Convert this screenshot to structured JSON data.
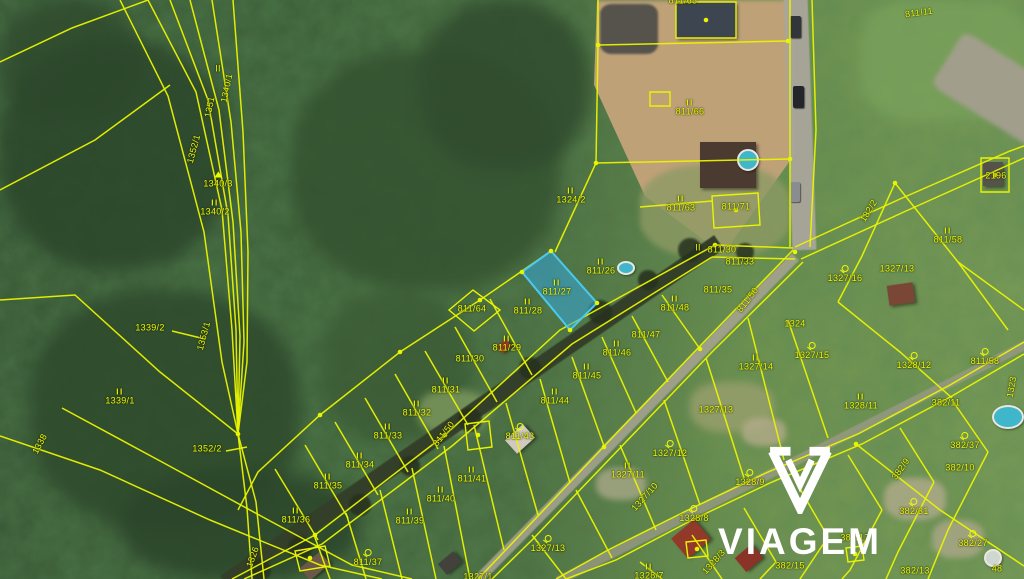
{
  "map": {
    "watermark": {
      "brand": "VIAGEM"
    },
    "highlight_parcel": {
      "number": "811/27",
      "fill": "#35a7dd",
      "stroke": "#49c8f0"
    },
    "line_color": "#e9f400",
    "label_color": "#f0fa00",
    "labels": [
      {
        "t": "1340/1",
        "x": 227,
        "y": 88,
        "r": -78
      },
      {
        "t": "1351",
        "x": 210,
        "y": 107,
        "r": -78
      },
      {
        "t": "1352/1",
        "x": 194,
        "y": 149,
        "r": -75
      },
      {
        "t": "1340/3",
        "x": 218,
        "y": 180,
        "s": "t"
      },
      {
        "t": "1340/2",
        "x": 215,
        "y": 208,
        "s": "II"
      },
      {
        "t": "II",
        "x": 218,
        "y": 69
      },
      {
        "t": "1339/2",
        "x": 150,
        "y": 328
      },
      {
        "t": "1353/1",
        "x": 204,
        "y": 336,
        "r": -75
      },
      {
        "t": "1339/1",
        "x": 120,
        "y": 397,
        "s": "II"
      },
      {
        "t": "1352/2",
        "x": 207,
        "y": 449
      },
      {
        "t": "1338",
        "x": 40,
        "y": 444,
        "r": -62
      },
      {
        "t": "1326",
        "x": 253,
        "y": 557,
        "r": -70
      },
      {
        "t": "1324/2",
        "x": 571,
        "y": 196,
        "s": "II"
      },
      {
        "t": "811/65",
        "x": 683,
        "y": 1
      },
      {
        "t": "811/66",
        "x": 690,
        "y": 108,
        "s": "II"
      },
      {
        "t": "811/63",
        "x": 681,
        "y": 204,
        "s": "II"
      },
      {
        "t": "811/71",
        "x": 736,
        "y": 207
      },
      {
        "t": "811/11",
        "x": 919,
        "y": 13,
        "r": -8
      },
      {
        "t": "182/2",
        "x": 869,
        "y": 211,
        "r": -58
      },
      {
        "t": "811/58",
        "x": 948,
        "y": 236,
        "s": "II"
      },
      {
        "t": "2196",
        "x": 996,
        "y": 176
      },
      {
        "t": "1327/16",
        "x": 845,
        "y": 274,
        "s": "o"
      },
      {
        "t": "1327/13",
        "x": 897,
        "y": 269
      },
      {
        "t": "1323",
        "x": 1012,
        "y": 387,
        "r": -80
      },
      {
        "t": "811/58",
        "x": 985,
        "y": 357,
        "s": "o"
      },
      {
        "t": "II",
        "x": 698,
        "y": 248
      },
      {
        "t": "811/30",
        "x": 722,
        "y": 250
      },
      {
        "t": "811/33",
        "x": 740,
        "y": 262
      },
      {
        "t": "811/35",
        "x": 718,
        "y": 290
      },
      {
        "t": "811/50",
        "x": 748,
        "y": 300,
        "r": -52
      },
      {
        "t": "811/50",
        "x": 444,
        "y": 434,
        "r": -52
      },
      {
        "t": "811/27",
        "x": 557,
        "y": 288,
        "s": "II"
      },
      {
        "t": "811/26",
        "x": 601,
        "y": 267,
        "s": "II"
      },
      {
        "t": "811/28",
        "x": 528,
        "y": 307,
        "s": "II"
      },
      {
        "t": "811/64",
        "x": 472,
        "y": 309
      },
      {
        "t": "811/29",
        "x": 507,
        "y": 344,
        "s": "II"
      },
      {
        "t": "811/30",
        "x": 470,
        "y": 359
      },
      {
        "t": "811/31",
        "x": 446,
        "y": 386,
        "s": "II"
      },
      {
        "t": "811/32",
        "x": 417,
        "y": 409,
        "s": "II"
      },
      {
        "t": "811/33",
        "x": 388,
        "y": 432,
        "s": "II"
      },
      {
        "t": "811/34",
        "x": 360,
        "y": 461,
        "s": "II"
      },
      {
        "t": "811/35",
        "x": 328,
        "y": 482,
        "s": "II"
      },
      {
        "t": "811/36",
        "x": 296,
        "y": 516,
        "s": "II"
      },
      {
        "t": "811/37",
        "x": 368,
        "y": 558,
        "s": "o"
      },
      {
        "t": "811/39",
        "x": 410,
        "y": 517,
        "s": "II"
      },
      {
        "t": "811/40",
        "x": 441,
        "y": 495,
        "s": "II"
      },
      {
        "t": "811/41",
        "x": 472,
        "y": 475,
        "s": "II"
      },
      {
        "t": "811/43",
        "x": 520,
        "y": 432,
        "s": "o"
      },
      {
        "t": "811/44",
        "x": 555,
        "y": 397,
        "s": "II"
      },
      {
        "t": "811/45",
        "x": 587,
        "y": 372,
        "s": "II"
      },
      {
        "t": "811/46",
        "x": 617,
        "y": 349,
        "s": "II"
      },
      {
        "t": "811/47",
        "x": 646,
        "y": 335
      },
      {
        "t": "811/48",
        "x": 675,
        "y": 304,
        "s": "II"
      },
      {
        "t": "1327/10",
        "x": 645,
        "y": 497,
        "r": -48
      },
      {
        "t": "1327/14",
        "x": 756,
        "y": 363,
        "s": "II"
      },
      {
        "t": "1327/15",
        "x": 812,
        "y": 351,
        "s": "o"
      },
      {
        "t": "1324",
        "x": 795,
        "y": 324
      },
      {
        "t": "1327/12",
        "x": 670,
        "y": 449,
        "s": "o"
      },
      {
        "t": "1327/11",
        "x": 628,
        "y": 471,
        "s": "II"
      },
      {
        "t": "1327/13",
        "x": 716,
        "y": 410
      },
      {
        "t": "1327/13",
        "x": 548,
        "y": 544,
        "s": "o"
      },
      {
        "t": "1327/1",
        "x": 478,
        "y": 577
      },
      {
        "t": "1328/9",
        "x": 750,
        "y": 478,
        "s": "o"
      },
      {
        "t": "1328/8",
        "x": 694,
        "y": 514,
        "s": "o"
      },
      {
        "t": "1328/7",
        "x": 649,
        "y": 572,
        "s": "II"
      },
      {
        "t": "1328/3",
        "x": 714,
        "y": 562,
        "r": -48
      },
      {
        "t": "1328/11",
        "x": 861,
        "y": 402,
        "s": "II"
      },
      {
        "t": "1328/12",
        "x": 914,
        "y": 361,
        "s": "o"
      },
      {
        "t": "382/11",
        "x": 946,
        "y": 403
      },
      {
        "t": "382/37",
        "x": 965,
        "y": 441,
        "s": "o"
      },
      {
        "t": "382/10",
        "x": 960,
        "y": 468
      },
      {
        "t": "382/9",
        "x": 901,
        "y": 469,
        "r": -55
      },
      {
        "t": "382/31",
        "x": 914,
        "y": 507,
        "s": "o"
      },
      {
        "t": "382/27",
        "x": 973,
        "y": 539,
        "s": "o"
      },
      {
        "t": "382/13",
        "x": 915,
        "y": 571
      },
      {
        "t": "382/15",
        "x": 790,
        "y": 566
      },
      {
        "t": "382/17",
        "x": 855,
        "y": 538
      },
      {
        "t": "48",
        "x": 997,
        "y": 569
      }
    ],
    "lines": [
      "148,0 196,92 222,210 232,330 238,434",
      "170,0 208,100 228,215 236,330 238,434",
      "190,0 219,110 233,222 240,336 238,434",
      "212,0 231,122 241,232 244,342 238,434",
      "233,0 243,132 248,252 247,362 238,434",
      "120,0 168,96 204,232 222,362 238,434",
      "238,434 247,508 252,579",
      "238,434 256,502 264,579",
      "0,62 72,28 148,0",
      "0,190 95,140 170,85",
      "0,300 75,295 160,372 238,434",
      "0,436 100,470 210,520 320,565 382,579",
      "62,408 162,462 272,522 352,565 412,579",
      "172,331 205,339",
      "226,451 247,447",
      "551,251 480,300 400,352 320,415 258,472 238,510",
      "522,272 570,330",
      "490,299 532,375",
      "455,327 497,402",
      "425,351 468,425",
      "395,374 438,449",
      "365,398 408,472",
      "335,422 378,495",
      "305,445 348,518",
      "275,469 318,540",
      "715,245 560,330 445,435 315,535 232,579",
      "712,257 572,344 452,446 322,544 244,579",
      "715,245 793,248",
      "712,257 795,259",
      "662,295 700,349",
      "632,316 668,382",
      "602,337 636,413",
      "572,357 604,446",
      "540,379 570,483",
      "506,403 538,515",
      "474,425 504,550",
      "444,446 470,579",
      "412,468 436,579",
      "380,490 402,579",
      "346,513 366,579",
      "314,535 330,579",
      "793,250 700,346 610,440 520,535 478,579",
      "803,262 712,352 622,446 532,540 492,579",
      "788,320 828,438",
      "748,318 784,460",
      "706,358 744,478",
      "664,400 700,505",
      "620,445 656,530",
      "576,490 612,558",
      "532,535 566,579",
      "1024,342 950,385 858,434 768,472 688,510 608,550 556,579",
      "1024,354 952,396 862,444 772,482 692,520 616,560 566,579",
      "952,400 988,452",
      "900,428 934,482",
      "848,455 882,510",
      "796,482 828,537",
      "744,508 776,562",
      "692,535 722,579",
      "640,562 662,579",
      "856,444 940,510 1024,566",
      "988,452 948,530 928,579",
      "934,482 898,552 886,579",
      "882,510 850,570 842,579",
      "828,537 800,579",
      "776,562 760,579",
      "795,247 900,199 1010,151 1024,146",
      "801,259 906,211 1024,158",
      "895,183 862,256 838,302",
      "895,183 958,262 1008,330",
      "838,302 900,352 952,398",
      "958,262 1024,310",
      "598,0 598,45 596,163 555,252",
      "598,45 788,41",
      "596,163 790,159",
      "790,0 790,247",
      "812,0 816,130 810,247",
      "640,207 712,201"
    ],
    "buildings": [
      "676,2 736,2 736,38 676,38",
      "650,92 670,92 670,106 650,106",
      "712,196 758,193 760,225 714,228",
      "981,158 1009,158 1009,192 981,192",
      "473,290 500,310 474,331 449,310",
      "295,551 325,546 330,566 300,571",
      "465,424 489,421 492,447 468,450",
      "686,542 706,540 708,556 688,558",
      "846,548 862,546 864,560 848,562"
    ],
    "blue_polygon": "551,251 597,303 570,330 522,272",
    "dots": [
      [
        238,
        434
      ],
      [
        551,
        251
      ],
      [
        597,
        303
      ],
      [
        570,
        330
      ],
      [
        522,
        272
      ],
      [
        715,
        245
      ],
      [
        795,
        252
      ],
      [
        598,
        45
      ],
      [
        788,
        41
      ],
      [
        790,
        159
      ],
      [
        596,
        163
      ],
      [
        445,
        435
      ],
      [
        315,
        535
      ],
      [
        480,
        300
      ],
      [
        400,
        352
      ],
      [
        320,
        415
      ],
      [
        895,
        183
      ],
      [
        856,
        444
      ],
      [
        700,
        349
      ],
      [
        604,
        447
      ],
      [
        706,
        20
      ],
      [
        736,
        210
      ],
      [
        995,
        175
      ],
      [
        310,
        558
      ],
      [
        478,
        435
      ],
      [
        697,
        549
      ],
      [
        855,
        554
      ]
    ],
    "scene": {
      "patches": [
        {
          "x": 0,
          "y": 0,
          "w": 140,
          "h": 120,
          "c": "#2f4a2d",
          "br": 45,
          "bl": 8,
          "op": 0.8
        },
        {
          "x": 0,
          "y": 40,
          "w": 230,
          "h": 230,
          "c": "#2c472b",
          "br": 45,
          "bl": 8,
          "op": 0.85
        },
        {
          "x": 30,
          "y": 290,
          "w": 270,
          "h": 240,
          "c": "#2e4a2c",
          "br": 45,
          "bl": 8,
          "op": 0.85
        },
        {
          "x": 290,
          "y": 50,
          "w": 270,
          "h": 240,
          "c": "#33512f",
          "br": 45,
          "bl": 8,
          "op": 0.8
        },
        {
          "x": 420,
          "y": 0,
          "w": 170,
          "h": 170,
          "c": "#304c2e",
          "br": 45,
          "bl": 8,
          "op": 0.85
        },
        {
          "x": 120,
          "y": 470,
          "w": 240,
          "h": 110,
          "c": "#2b452a",
          "br": 45,
          "bl": 8,
          "op": 0.85
        },
        {
          "x": 320,
          "y": 290,
          "w": 150,
          "h": 150,
          "c": "#3a5a34",
          "br": 45,
          "bl": 8,
          "op": 0.75
        },
        {
          "x": 860,
          "y": 0,
          "w": 168,
          "h": 120,
          "c": "#7ba35c",
          "br": 30,
          "bl": 6,
          "op": 0.7
        },
        {
          "x": 555,
          "y": 0,
          "w": 300,
          "h": 265,
          "c": "#bfa178",
          "cp": "polygon(14% 0, 79% 0, 80% 58%, 56% 96%, 30% 74%, 13% 32%)",
          "bl": 2,
          "op": 1
        },
        {
          "x": 600,
          "y": 4,
          "w": 58,
          "h": 50,
          "c": "#56534c",
          "br": 20,
          "bl": 1,
          "op": 1
        },
        {
          "x": 640,
          "y": 165,
          "w": 150,
          "h": 92,
          "c": "#8d9a64",
          "br": 40,
          "bl": 3,
          "op": 0.8
        },
        {
          "x": 975,
          "y": 25,
          "w": 64,
          "h": 140,
          "c": "#a49f8f",
          "br": 10,
          "bl": 2,
          "op": 0.95,
          "rot": -58
        },
        {
          "x": 690,
          "y": 382,
          "w": 84,
          "h": 50,
          "c": "#9aa06e",
          "br": 40,
          "bl": 4,
          "op": 0.8
        },
        {
          "x": 596,
          "y": 468,
          "w": 50,
          "h": 32,
          "c": "#a8a887",
          "br": 40,
          "bl": 3,
          "op": 0.8
        },
        {
          "x": 742,
          "y": 418,
          "w": 44,
          "h": 28,
          "c": "#b3ab8a",
          "br": 40,
          "bl": 3,
          "op": 0.8
        },
        {
          "x": 884,
          "y": 478,
          "w": 62,
          "h": 42,
          "c": "#b5ad8f",
          "br": 40,
          "bl": 3,
          "op": 0.75
        },
        {
          "x": 932,
          "y": 520,
          "w": 52,
          "h": 38,
          "c": "#b0a98c",
          "br": 40,
          "bl": 3,
          "op": 0.75
        },
        {
          "x": 418,
          "y": 390,
          "w": 70,
          "h": 44,
          "c": "#7e9a5e",
          "br": 40,
          "bl": 4,
          "op": 0.8
        }
      ],
      "roads": [
        {
          "cx": 472,
          "cy": 412,
          "len": 600,
          "th": 17,
          "ang": -34.6,
          "c": "#333f28",
          "op": 1
        },
        {
          "cx": 637,
          "cy": 418,
          "len": 452,
          "th": 10,
          "ang": -45.5,
          "c": "#a8a492",
          "op": 0.85
        },
        {
          "cx": 792,
          "cy": 462,
          "len": 525,
          "th": 9,
          "ang": -26.8,
          "c": "#9c9a88",
          "op": 0.75
        },
        {
          "cx": 800,
          "cy": 124,
          "len": 252,
          "th": 24,
          "ang": 88,
          "c": "#a9a69b",
          "op": 0.95
        }
      ],
      "trees": [
        {
          "x": 690,
          "y": 250,
          "r": 12
        },
        {
          "x": 648,
          "y": 280,
          "r": 10
        },
        {
          "x": 600,
          "y": 312,
          "r": 12
        },
        {
          "x": 530,
          "y": 368,
          "r": 11
        },
        {
          "x": 470,
          "y": 420,
          "r": 12
        },
        {
          "x": 410,
          "y": 466,
          "r": 10
        },
        {
          "x": 360,
          "y": 505,
          "r": 11
        },
        {
          "x": 300,
          "y": 548,
          "r": 12
        },
        {
          "x": 745,
          "y": 252,
          "r": 9
        },
        {
          "x": 260,
          "y": 570,
          "r": 11
        }
      ],
      "houses": [
        {
          "x": 676,
          "y": 2,
          "w": 60,
          "h": 36,
          "c": "#3d4550",
          "rot": 0
        },
        {
          "x": 700,
          "y": 142,
          "w": 56,
          "h": 46,
          "c": "#4a3a30",
          "rot": 0
        },
        {
          "x": 888,
          "y": 284,
          "w": 26,
          "h": 20,
          "c": "#7a4636",
          "rot": -8
        },
        {
          "x": 983,
          "y": 162,
          "w": 20,
          "h": 24,
          "c": "#55524a",
          "rot": 0
        },
        {
          "x": 508,
          "y": 430,
          "w": 24,
          "h": 18,
          "c": "#cfc9c0",
          "rot": -42
        },
        {
          "x": 676,
          "y": 526,
          "w": 30,
          "h": 26,
          "c": "#93392a",
          "rot": -40
        },
        {
          "x": 738,
          "y": 549,
          "w": 22,
          "h": 18,
          "c": "#8a3326",
          "rot": -40
        },
        {
          "x": 302,
          "y": 558,
          "w": 26,
          "h": 16,
          "c": "#6b5848",
          "rot": -40
        },
        {
          "x": 440,
          "y": 556,
          "w": 20,
          "h": 14,
          "c": "#42413c",
          "rot": -40
        },
        {
          "x": 498,
          "y": 342,
          "w": 12,
          "h": 9,
          "c": "#a03a28",
          "rot": -40
        }
      ],
      "pools": [
        {
          "x": 748,
          "y": 160,
          "rx": 11,
          "ry": 11,
          "c": "#3fb6c9"
        },
        {
          "x": 626,
          "y": 268,
          "rx": 9,
          "ry": 7,
          "c": "#3fb6c9"
        },
        {
          "x": 1008,
          "y": 417,
          "rx": 16,
          "ry": 12,
          "c": "#3fb6c9"
        },
        {
          "x": 993,
          "y": 558,
          "rx": 9,
          "ry": 9,
          "c": "#cfd8d0"
        }
      ],
      "cars": [
        {
          "x": 790,
          "y": 16,
          "w": 11,
          "h": 22,
          "c": "#32363a"
        },
        {
          "x": 793,
          "y": 86,
          "w": 11,
          "h": 22,
          "c": "#23262a"
        },
        {
          "x": 790,
          "y": 182,
          "w": 10,
          "h": 20,
          "c": "#8a8d90"
        }
      ]
    }
  }
}
